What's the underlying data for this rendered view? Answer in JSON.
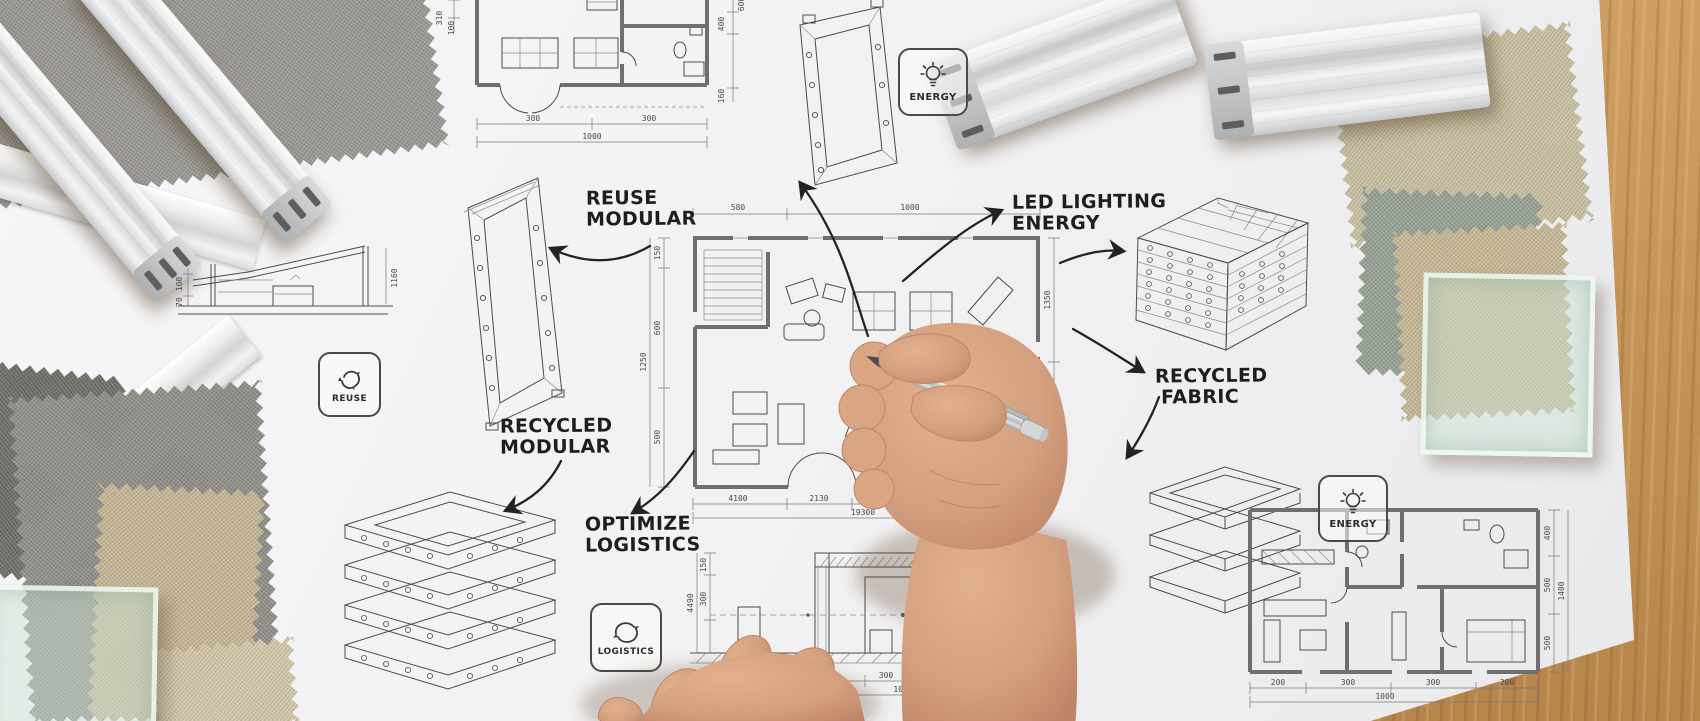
{
  "annotations": {
    "reuse_modular": [
      "REUSE",
      "MODULAR"
    ],
    "led_lighting_energy": [
      "LED LIGHTING",
      "ENERGY"
    ],
    "recycled_fabric": [
      "RECYCLED",
      "FABRIC"
    ],
    "recycled_modular": [
      "RECYCLED",
      "MODULAR"
    ],
    "optimize_logistics": [
      "OPTIMIZE",
      "LOGISTICS"
    ]
  },
  "badges": {
    "energy_top": {
      "label": "ENERGY",
      "icon": "lightbulb-icon"
    },
    "reuse": {
      "label": "REUSE",
      "icon": "recycle-arrows-icon"
    },
    "logistics": {
      "label": "LOGISTICS",
      "icon": "circular-arrows-icon"
    },
    "energy_right": {
      "label": "ENERGY",
      "icon": "lightbulb-icon"
    }
  },
  "drawings": {
    "top_left_plan": {
      "dims_left": [
        "310",
        "100"
      ],
      "dims_right": [
        "600",
        "400",
        "160"
      ],
      "dims_bottom": [
        "300",
        "300"
      ],
      "dim_bottom_total": "1000"
    },
    "sloped_structure": {
      "dims": [
        "100",
        "70",
        "1160"
      ]
    },
    "central_plan": {
      "dims_top": [
        "580",
        "1000"
      ],
      "dims_left": [
        "150",
        "600",
        "500"
      ],
      "dim_left_total": "1250",
      "dims_right": [
        "1350",
        "1750"
      ],
      "dims_bottom": [
        "4100",
        "2130",
        "6000"
      ],
      "dim_bottom_total": "19300"
    },
    "portal_elevation": {
      "dims_left": [
        "150",
        "300"
      ],
      "dim_left_total": "4490",
      "dims_bottom": [
        "290",
        "300",
        "200",
        "260"
      ],
      "dim_bottom_total": "1000"
    },
    "bottom_right_plan": {
      "dims_right": [
        "400",
        "500",
        "500"
      ],
      "dim_right_total": "1400",
      "dims_bottom": [
        "200",
        "300",
        "300",
        "200"
      ],
      "dim_bottom_total": "1000"
    }
  },
  "colors": {
    "wood": "#c29155",
    "paper": "#f3f3f5",
    "ink": "#4c4c4c",
    "wall": "#6f6f6f",
    "skin": "#d7a382",
    "pen_silver": "#c9ccce",
    "glass_tint": "#cee3d5",
    "fabric_gray": "#908e88",
    "fabric_beige": "#cbc1a2",
    "fabric_green": "#97a294",
    "fabric_dark": "#6e6c66"
  }
}
